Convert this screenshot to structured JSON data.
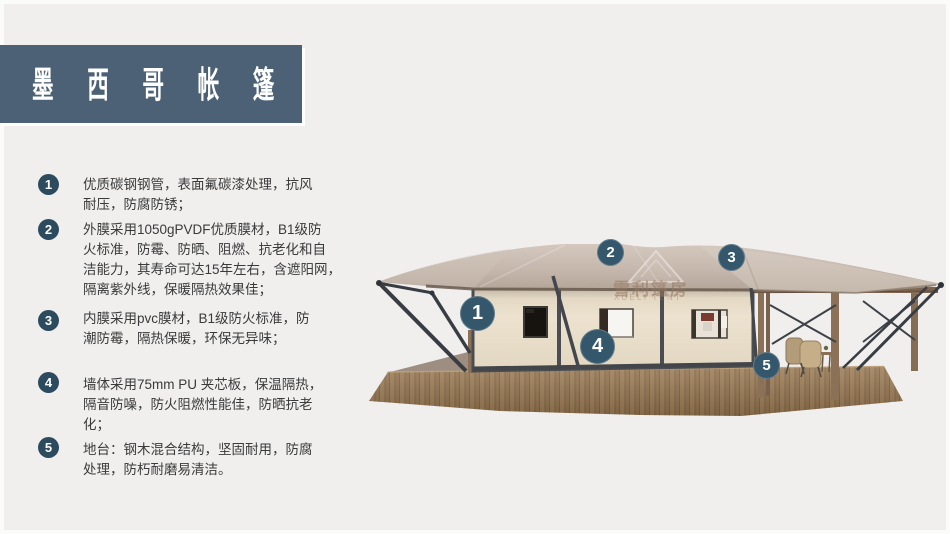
{
  "title": "墨西哥帐篷",
  "features": [
    {
      "num": "1",
      "text": "优质碳钢钢管，表面氟碳漆处理，抗风\n耐压，防腐防锈；"
    },
    {
      "num": "2",
      "text": "外膜采用1050gPVDF优质膜材，B1级防\n火标准，防霉、防晒、阻燃、抗老化和自\n洁能力，其寿命可达15年左右，含遮阳网，\n隔离紫外线，保暖隔热效果佳；"
    },
    {
      "num": "3",
      "text": "内膜采用pvc膜材，B1级防火标准，防\n潮防霉，隔热保暖，环保无异味；"
    },
    {
      "num": "4",
      "text": "墙体采用75mm PU 夹芯板，保温隔热，\n隔音防噪，防火阻燃性能佳，防晒抗老\n化；"
    },
    {
      "num": "5",
      "text": "地台：钢木混合结构，坚固耐用，防腐\n处理，防朽耐磨易清洁。"
    }
  ],
  "callouts": [
    {
      "num": "1"
    },
    {
      "num": "2"
    },
    {
      "num": "3"
    },
    {
      "num": "4"
    },
    {
      "num": "5"
    }
  ],
  "watermark": {
    "cn": "雪利篷房",
    "en": "XUELI TENT"
  },
  "colors": {
    "title_bar": "#4c6175",
    "list_circle": "#2c4b5f",
    "callout_circle": "#35576b",
    "background": "#f0efee",
    "text": "#3a3a3a",
    "roof_membrane": "#c8bab0",
    "wall_panel": "#e9dfcc",
    "steel_frame": "#3a3f45",
    "deck_wood": "#9a7858"
  }
}
